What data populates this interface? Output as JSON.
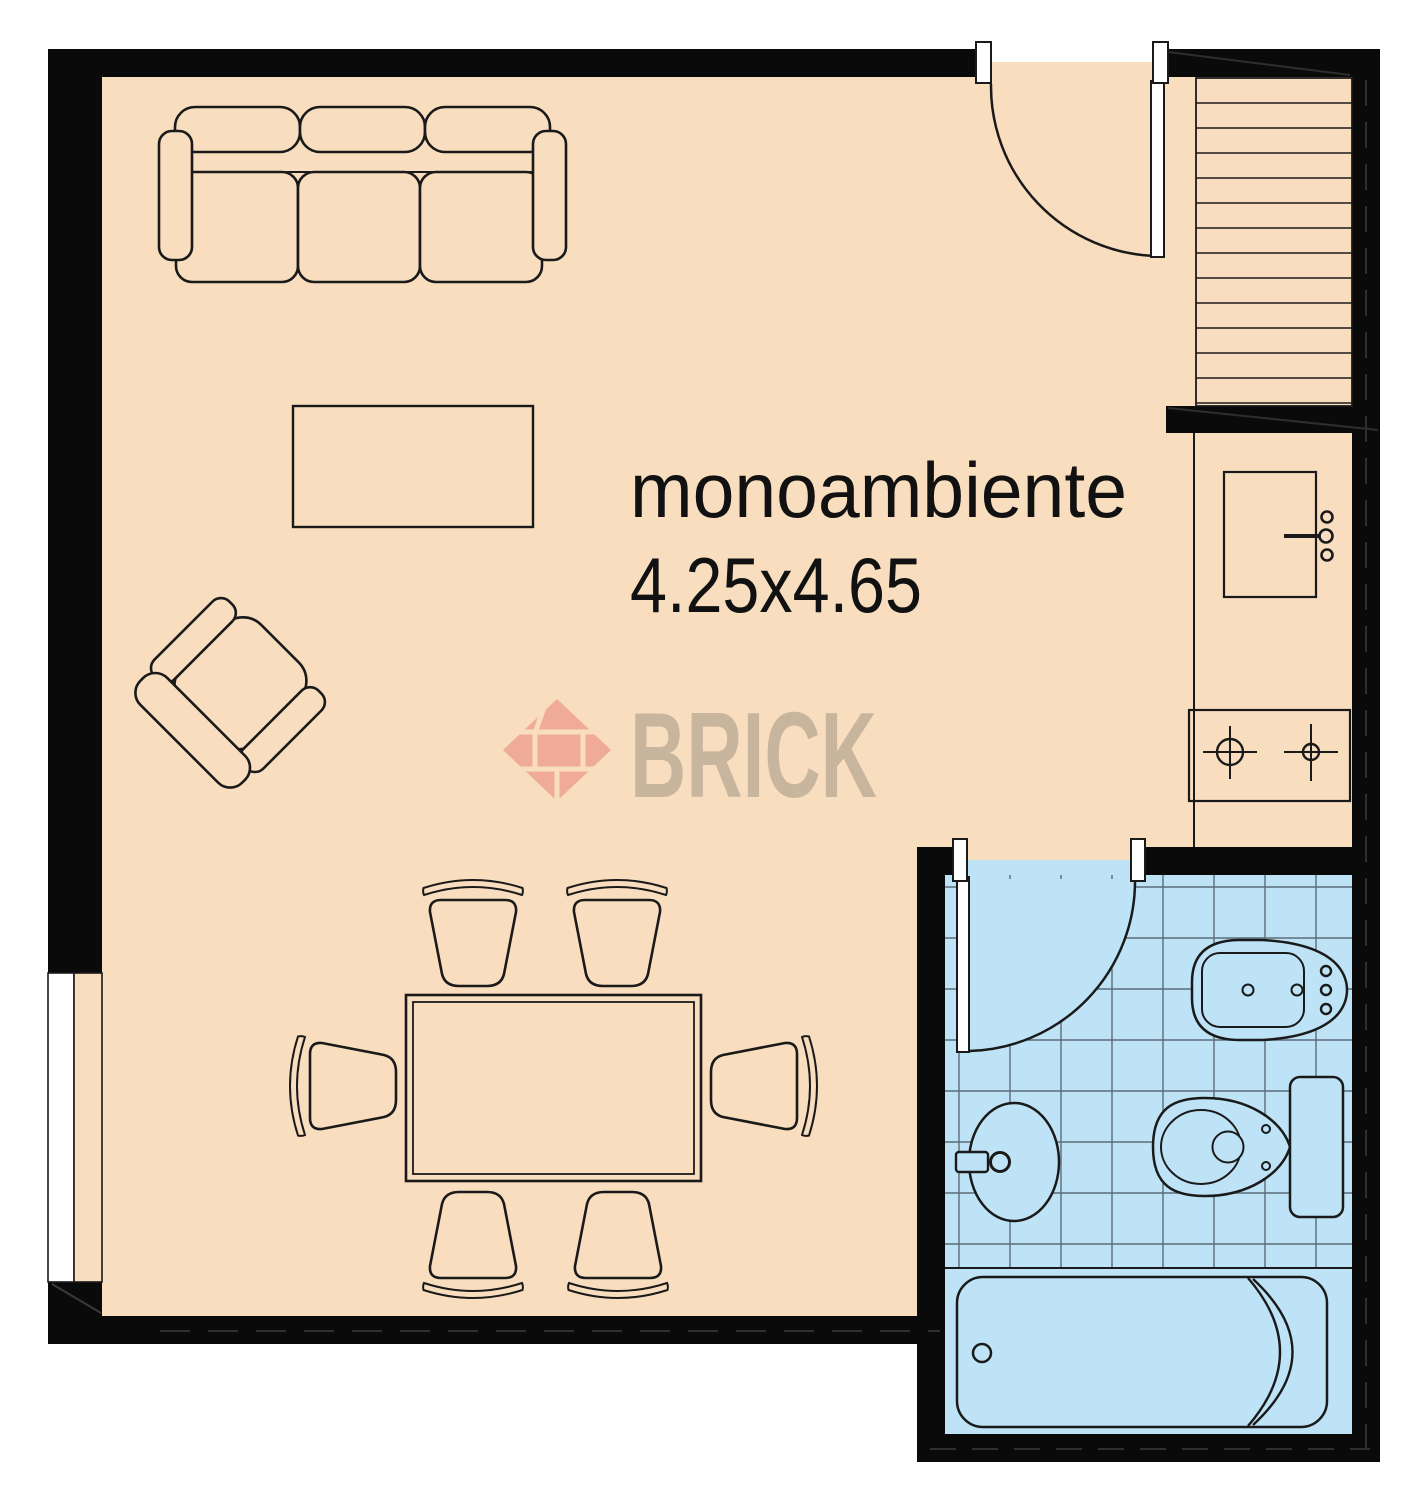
{
  "labels": {
    "room_name": "monoambiente",
    "room_dimensions": "4.25x4.65"
  },
  "watermark": {
    "brand": "BRICK"
  },
  "colors": {
    "floor": "#F9DDBF",
    "bathroom_floor": "#BEE3F6",
    "wall": "#0A0A0A",
    "outline": "#1A1A1A",
    "tile_grid": "#5D6C78",
    "watermark_brick": "#E57A72",
    "watermark_text": "#8F8578"
  }
}
